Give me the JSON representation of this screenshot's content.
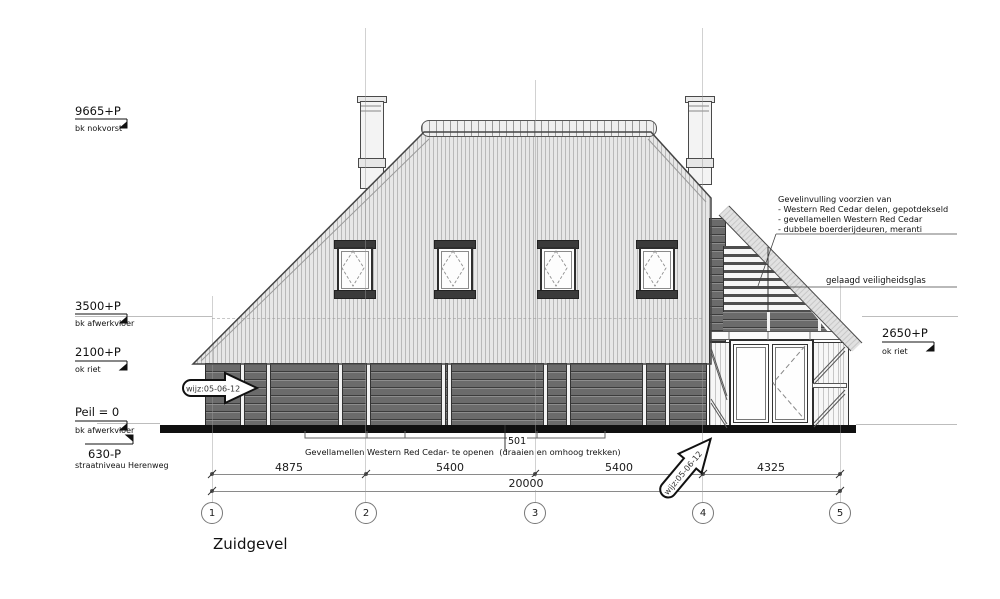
{
  "title": "Zuidgevel",
  "levels": {
    "ridge": {
      "value": "9665+P",
      "sub": "bk nokvorst"
    },
    "floor": {
      "value": "3500+P",
      "sub": "bk afwerkvloer"
    },
    "thatch_left": {
      "value": "2100+P",
      "sub": "ok riet"
    },
    "peil": {
      "value": "Peil = 0",
      "sub": "bk afwerkvloer"
    },
    "street": {
      "value": "630-P",
      "sub": "straatniveau Herenweg"
    },
    "thatch_right": {
      "value": "2650+P",
      "sub": "ok riet"
    }
  },
  "annotation_block": {
    "line1": "Gevelinvulling voorzien van",
    "line2": "- Western Red Cedar delen, gepotdekseld",
    "line3": "- gevellamellen Western Red Cedar",
    "line4": "- dubbele boerderijdeuren, meranti"
  },
  "glass_label": "gelaagd veiligheidsglas",
  "lamellen_note": "Gevellamellen Western Red Cedar- te openen  (draaien en omhoog trekken)",
  "tag_501": "501",
  "dimensions": {
    "d1": "4875",
    "d2": "5400",
    "d3": "5400",
    "d4": "4325",
    "total": "20000"
  },
  "grid_bubbles": [
    "1",
    "2",
    "3",
    "4",
    "5"
  ],
  "revision": {
    "label": "wijz:05-06-12"
  },
  "colors": {
    "wall_dark": "#6b6b6b",
    "roof_light": "#e7e7e7",
    "outline": "#444444",
    "ground": "#101010"
  }
}
